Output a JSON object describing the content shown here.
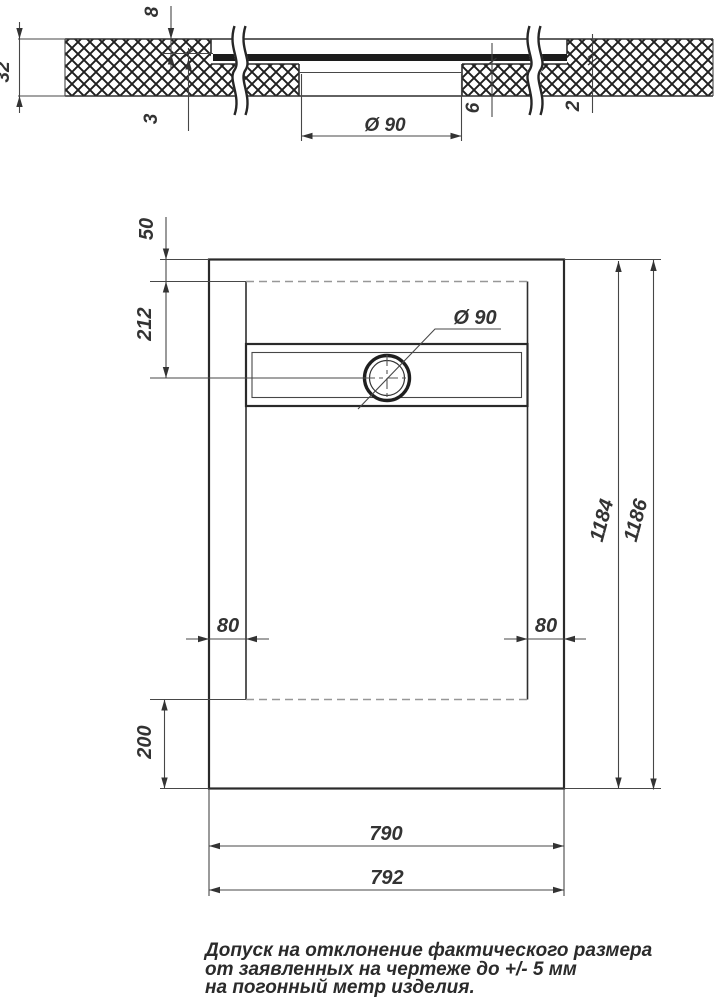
{
  "section": {
    "thickness": "32",
    "recess_depth": "8",
    "cover_thickness": "3",
    "drain_diameter": "Ø 90",
    "trough_depth": "6",
    "gap": "2"
  },
  "plan": {
    "top_inset": "50",
    "drain_offset": "212",
    "drain_diameter": "Ø 90",
    "side_inset_left": "80",
    "side_inset_right": "80",
    "inner_length": "1184",
    "outer_length": "1186",
    "bottom_inset": "200",
    "inner_width": "790",
    "outer_width": "792"
  },
  "note": {
    "line1": "Допуск на отклонение фактического размера",
    "line2": "от заявленных на чертеже до +/- 5 мм",
    "line3": "на погонный метр изделия."
  },
  "colors": {
    "line": "#2a2a2a",
    "dim": "#474747",
    "dashed": "#979797",
    "background": "#ffffff"
  }
}
